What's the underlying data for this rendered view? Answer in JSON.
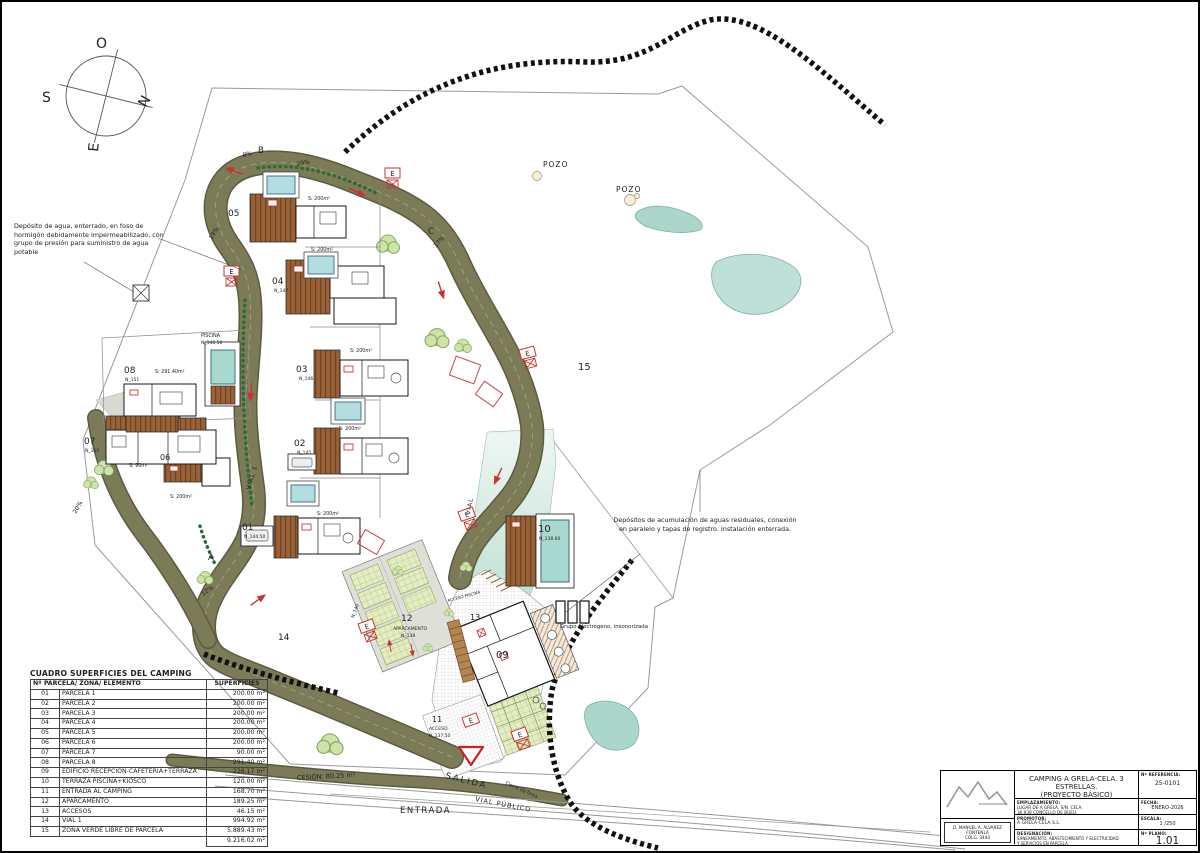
{
  "compass": {
    "o": "O",
    "s": "S",
    "n": "N",
    "e": "E"
  },
  "annotations": {
    "water_tank": "Depósito de agua, enterrado, en foso de hormigón debidamente impermeabilizado, con grupo de presión para suministro de agua potable",
    "sewage": "Depósitos de acumulación de aguas residuales, conexión en paralelo y tapas de registro. Instalación enterrada.",
    "generator": "Grupo electrógeno, insonorizada"
  },
  "plan": {
    "pozo1": "POZO",
    "pozo2": "POZO",
    "zone15": "15",
    "e_symbol": "E",
    "road_labels": {
      "pct8": "8%",
      "b": "B",
      "pct20_top": "20%",
      "pct19": "19%",
      "c": "C",
      "pct17": "17%",
      "a": "A",
      "pct12": "12%",
      "pct20_west": "20%",
      "vial1": "VIAL 1",
      "vial": "VIAL",
      "n140": "N_140",
      "seg14": "14"
    },
    "bottom": {
      "cesion": "CESIÓN: 80.25 m²",
      "salida": "SALIDA",
      "entrada": "ENTRADA",
      "vial_publico": "VIAL PÚBLICO",
      "cierre": "Cierre de finca",
      "acceso_piscina": "ACCESO PISCINA"
    },
    "parcels": {
      "p01": {
        "num": "01",
        "elev": "N_144.50",
        "area": "S: 200m²"
      },
      "p02": {
        "num": "02",
        "elev": "N_145",
        "area": "S: 200m²"
      },
      "p03": {
        "num": "03",
        "elev": "N_146",
        "area": "S: 200m²"
      },
      "p04": {
        "num": "04",
        "elev": "N_147",
        "area": "S: 200m²"
      },
      "p05": {
        "num": "05",
        "area": "S: 200m²"
      },
      "p06": {
        "num": "06",
        "area": "S: 200m²"
      },
      "p07": {
        "num": "07",
        "elev": "N_150",
        "area": "S: 90m²"
      },
      "p08": {
        "num": "08",
        "elev": "N_151",
        "area": "S: 291.40m²",
        "piscina": "PISCINA",
        "piscina_elev": "N_146.50"
      },
      "p09": {
        "num": "09"
      },
      "p10": {
        "num": "10",
        "elev": "N_138.60"
      },
      "p11": {
        "num": "11",
        "label": "ACCESO",
        "elev": "N_137.50"
      },
      "p12": {
        "num": "12",
        "label": "APARCAMENTO",
        "elev": "N_138"
      },
      "p13": {
        "num": "13"
      }
    }
  },
  "surfaces_table": {
    "title": "CUADRO SUPERFICIES DEL CAMPING",
    "col_element": "Nº PARCELA/ ZONA/ ELEMENTO",
    "col_area": "SUPERFICIES",
    "rows": [
      [
        "01",
        "PARCELA 1",
        "200.00 m²"
      ],
      [
        "02",
        "PARCELA 2",
        "200.00 m²"
      ],
      [
        "03",
        "PARCELA 3",
        "200.00 m²"
      ],
      [
        "04",
        "PARCELA 4",
        "200.00 m²"
      ],
      [
        "05",
        "PARCELA 5",
        "200.00 m²"
      ],
      [
        "06",
        "PARCELA 6",
        "200.00 m²"
      ],
      [
        "07",
        "PARCELA 7",
        "90.00 m²"
      ],
      [
        "08",
        "PARCELA 8",
        "291.40 m²"
      ],
      [
        "09",
        "EDIFICIO RECEPCIÓN-CAFETERÍA+TERRAZA",
        "226.17 m²"
      ],
      [
        "10",
        "TERRAZA PISCINA+KIOSCO",
        "120.00 m²"
      ],
      [
        "11",
        "ENTRADA AL CAMPING",
        "168.70 m²"
      ],
      [
        "12",
        "APARCAMENTO",
        "189.25 m²"
      ],
      [
        "13",
        "ACCESOS",
        "46.15 m²"
      ],
      [
        "14",
        "VIAL 1",
        "994.92 m²"
      ],
      [
        "15",
        "ZONA VERDE LIBRE DE PARCELA",
        "5.889.43 m²"
      ]
    ],
    "total": "9.216.02 m²"
  },
  "title_block": {
    "title_line1": "CAMPING A GRELA-CELA. 3 ESTRELLAS.",
    "title_line2": "(PROYECTO BÁSICO)",
    "ref_label": "Nº REFERENCIA:",
    "ref_value": "25-0101",
    "site_label": "EMPLAZAMIENTO:",
    "site_line1": "LUGAR DE A GRELA, S/N. CELA.",
    "site_line2": "36.939 CONCELLO DE BUEU.",
    "date_label": "FECHA:",
    "date_value": "ENERO-2026",
    "promoter_label": "PROMOTOR:",
    "promoter_value": "A GRELA-CELA S.L.",
    "scale_label": "ESCALA:",
    "scale_value": "1 /250",
    "designation_label": "DESIGNACIÓN:",
    "designation_line1": "SANEAMIENTO, ABASTECIMIENTO Y ELECTRICIDAD",
    "designation_line2": "Y SERVICIOS EN PARCELA.",
    "plan_label": "Nº PLANO:",
    "plan_value": "1.01",
    "architect_line1": "D. MANUEL A. ÁLVAREZ FONTENLA",
    "architect_line2": "COLG. 3444"
  }
}
